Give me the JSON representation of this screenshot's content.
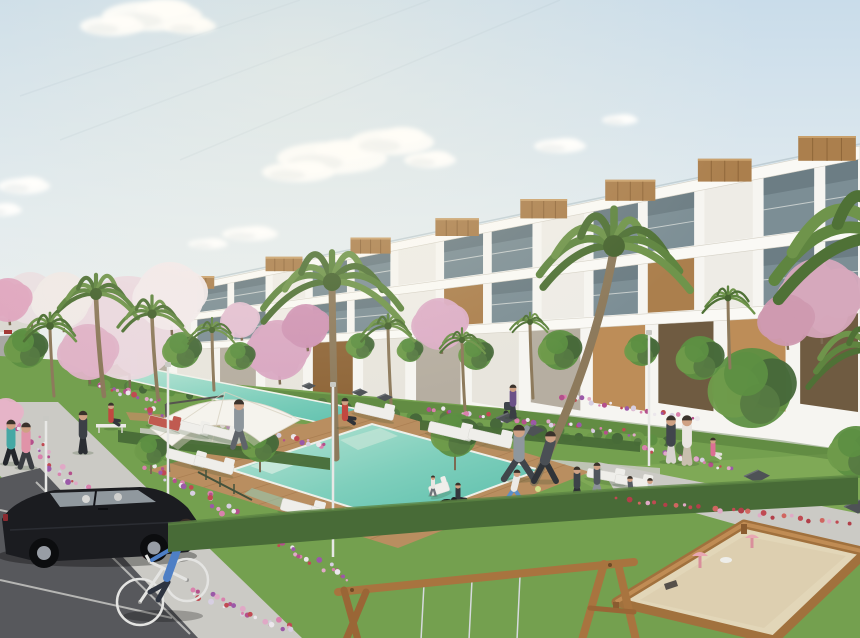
{
  "scene": {
    "description": "Photorealistic architectural rendering of a modern white terraced apartment complex with wooden accents, landscaped gardens with palm trees and pink blossoming trees, a turquoise swimming pool with wooden deck, lap pool, white sun loungers and cantilever umbrella, residents exercising and strolling, a parking area with a black hatchback, a cyclist, and a children's sandbox playground with a wooden swing frame in the foreground under a pale blue sky with wispy clouds.",
    "palette": {
      "sky_top": "#c9dcea",
      "sky_mid": "#e2ebef",
      "sky_low": "#f0f0ec",
      "cloud": "#ffffff",
      "building": "#f6f5f1",
      "fascia": "#faf9f5",
      "recess": "#b6aea1",
      "glass": "#71848d",
      "glass_light": "#aebfc6",
      "wood": "#ab7f4d",
      "wood_dark": "#8f6639",
      "tan_wall": "#bd8d58",
      "tan_shadow": "#6f5b41",
      "grass": "#74a04f",
      "grass_light": "#8fb35f",
      "grass_dark": "#41682f",
      "hedge": "#486b37",
      "deck": "#b98e60",
      "deck_dark": "#a2764a",
      "pool_light": "#b8e4d4",
      "pool": "#7fcfbc",
      "pool_deep": "#56bca9",
      "path": "#cbcac5",
      "asphalt": "#57585c",
      "sand": "#e2d6b8",
      "car": "#1b1c20",
      "white": "#efeeea",
      "bench": "#4e5256",
      "lamp": "#e8e8e6",
      "trunk": "#8d7a5c",
      "palm1": "#4f7136",
      "palm2": "#5f8540",
      "palm3": "#6f944b",
      "skin": "#cfa184"
    },
    "sky": {
      "clouds": [
        {
          "cx": 152,
          "cy": 16,
          "rx": 50,
          "ry": 15
        },
        {
          "cx": 112,
          "cy": 26,
          "rx": 32,
          "ry": 10
        },
        {
          "cx": 190,
          "cy": 26,
          "rx": 26,
          "ry": 8
        },
        {
          "cx": 332,
          "cy": 158,
          "rx": 55,
          "ry": 16
        },
        {
          "cx": 392,
          "cy": 142,
          "rx": 42,
          "ry": 13
        },
        {
          "cx": 298,
          "cy": 172,
          "rx": 36,
          "ry": 10
        },
        {
          "cx": 430,
          "cy": 160,
          "rx": 26,
          "ry": 8
        },
        {
          "cx": 24,
          "cy": 186,
          "rx": 26,
          "ry": 8
        },
        {
          "cx": 2,
          "cy": 210,
          "rx": 20,
          "ry": 6
        },
        {
          "cx": 250,
          "cy": 234,
          "rx": 28,
          "ry": 7
        },
        {
          "cx": 208,
          "cy": 244,
          "rx": 20,
          "ry": 5
        },
        {
          "cx": 560,
          "cy": 146,
          "rx": 26,
          "ry": 7
        },
        {
          "cx": 620,
          "cy": 120,
          "rx": 18,
          "ry": 5
        }
      ],
      "streaks": [
        {
          "x1": 430,
          "y1": 0,
          "x2": 60,
          "y2": 140
        },
        {
          "x1": 560,
          "y1": 0,
          "x2": 180,
          "y2": 160
        },
        {
          "x1": 300,
          "y1": 0,
          "x2": 20,
          "y2": 96
        }
      ]
    },
    "building": {
      "x0": 88,
      "x1": 860,
      "lines": [
        {
          "yl": 306,
          "yr": 146
        },
        {
          "yl": 328,
          "yr": 224
        },
        {
          "yl": 350,
          "yr": 300
        },
        {
          "yl": 374,
          "yr": 378
        }
      ],
      "fasciaL": 5,
      "fasciaR": 13,
      "roofBoxes": [
        0.12,
        0.23,
        0.34,
        0.45,
        0.56,
        0.67,
        0.79,
        0.92
      ]
    },
    "ground": {
      "polys": [
        {
          "n": "grass-base",
          "pts": "0,356 60,360 88,372 300,390 500,408 700,432 860,452 860,638 0,638",
          "f": "grass"
        },
        {
          "n": "grass-sun-patch",
          "pts": "560,470 860,452 860,520 620,502",
          "f": "grass_light",
          "o": 0.45
        },
        {
          "n": "grass-sun-patch",
          "pts": "180,430 360,448 360,470 200,452",
          "f": "grass_light",
          "o": 0.3
        },
        {
          "n": "building-shadow",
          "pts": "88,374 300,392 560,414 780,440 860,452 860,464 780,452 560,426 300,404 88,386",
          "f": "grass_dark",
          "o": 0.35
        },
        {
          "n": "mid-walkway",
          "pts": "140,428 660,468 660,480 140,440",
          "f": "path",
          "o": 0.85
        },
        {
          "n": "right-walkway",
          "pts": "598,462 862,514 862,560 614,490",
          "f": "path"
        },
        {
          "n": "left-sidewalk",
          "pts": "0,402 58,402 302,638 180,638 0,476",
          "f": "path"
        },
        {
          "n": "parking-asphalt",
          "pts": "0,478 40,468 198,638 0,638",
          "f": "asphalt"
        }
      ],
      "parkingLines": [
        {
          "x1": 0,
          "y1": 510,
          "x2": 128,
          "y2": 538
        },
        {
          "x1": 0,
          "y1": 580,
          "x2": 172,
          "y2": 618
        },
        {
          "x1": 36,
          "y1": 482,
          "x2": 190,
          "y2": 634
        }
      ]
    },
    "water": {
      "lapPool": "120,378 156,370 394,416 352,430",
      "lapDeck": "126,412 394,430 398,440 130,420",
      "mainDeck": "148,470 368,406 590,472 398,548",
      "mainPool": "232,470 372,424 540,470 398,522",
      "highlights": [
        {
          "pts": "250,466 290,452 306,460 272,474",
          "f": "#cdeadd",
          "o": 0.85
        },
        {
          "pts": "340,440 380,428 398,436 358,450",
          "f": "#bfe4d4",
          "o": 0.8
        },
        {
          "pts": "252,488 296,502 282,508 244,494",
          "f": "#8fd3c0",
          "o": 0.5
        }
      ],
      "upperHedges": [
        "118,430 330,458 330,470 118,442",
        "420,420 640,442 640,452 420,430"
      ]
    },
    "flowerBeds": [
      {
        "x1": 30,
        "y1": 436,
        "x2": 148,
        "y2": 556,
        "n": 46,
        "s": 10
      },
      {
        "x1": 152,
        "y1": 464,
        "x2": 348,
        "y2": 584,
        "n": 55,
        "s": 9
      },
      {
        "x1": 142,
        "y1": 410,
        "x2": 330,
        "y2": 448,
        "n": 38,
        "s": 7
      },
      {
        "x1": 428,
        "y1": 408,
        "x2": 638,
        "y2": 434,
        "n": 34,
        "s": 6
      },
      {
        "x1": 560,
        "y1": 396,
        "x2": 700,
        "y2": 420,
        "n": 24,
        "s": 5
      },
      {
        "x1": 642,
        "y1": 448,
        "x2": 736,
        "y2": 470,
        "n": 20,
        "s": 5
      },
      {
        "x1": 192,
        "y1": 592,
        "x2": 298,
        "y2": 634,
        "n": 28,
        "s": 8
      },
      {
        "x1": 0,
        "y1": 416,
        "x2": 26,
        "y2": 430,
        "n": 10,
        "s": 5
      },
      {
        "x1": 96,
        "y1": 386,
        "x2": 160,
        "y2": 402,
        "n": 16,
        "s": 5
      }
    ],
    "redBedOnHedge": {
      "x1": 620,
      "y1": 500,
      "x2": 858,
      "y2": 524,
      "n": 26,
      "s": 4
    },
    "greenScatter": {
      "x1": 92,
      "y1": 382,
      "x2": 690,
      "y2": 448,
      "n": 60,
      "s": 8
    },
    "flowerColors": [
      "#d981ad",
      "#b4508c",
      "#ece7ec",
      "#c04a52",
      "#9b59a8",
      "#e0a9c6",
      "#d7cfe2"
    ],
    "redColors": [
      "#c04a52",
      "#b23f49",
      "#d06660",
      "#e0a9c6"
    ],
    "greenColors": [
      "#5d8f42",
      "#47683a",
      "#6f9b4b",
      "#567a42"
    ],
    "blossoms": [
      {
        "cx": 128,
        "cy": 328,
        "r": 52,
        "c": "#ead8de"
      },
      {
        "cx": 170,
        "cy": 296,
        "r": 34,
        "c": "#f1e9ea"
      },
      {
        "cx": 88,
        "cy": 352,
        "r": 28,
        "c": "#dfb3c7"
      },
      {
        "cx": 278,
        "cy": 350,
        "r": 30,
        "c": "#d9a6c2"
      },
      {
        "cx": 306,
        "cy": 326,
        "r": 22,
        "c": "#cf93b4"
      },
      {
        "cx": 440,
        "cy": 324,
        "r": 26,
        "c": "#dcaec7"
      },
      {
        "cx": 820,
        "cy": 298,
        "r": 40,
        "c": "#d6a8bc"
      },
      {
        "cx": 786,
        "cy": 320,
        "r": 26,
        "c": "#cf9ab0"
      },
      {
        "cx": 30,
        "cy": 298,
        "r": 26,
        "c": "#eadfe2"
      },
      {
        "cx": 62,
        "cy": 300,
        "r": 28,
        "c": "#efe9e6"
      },
      {
        "cx": 8,
        "cy": 300,
        "r": 22,
        "c": "#dfa8c0"
      },
      {
        "cx": 6,
        "cy": 414,
        "r": 16,
        "c": "#e6b4c8"
      },
      {
        "cx": 240,
        "cy": 320,
        "r": 18,
        "c": "#e3c0d2"
      }
    ],
    "greenTrees": [
      {
        "cx": 752,
        "cy": 388,
        "r": 40
      },
      {
        "cx": 700,
        "cy": 358,
        "r": 22
      },
      {
        "cx": 560,
        "cy": 350,
        "r": 20
      },
      {
        "cx": 476,
        "cy": 354,
        "r": 16
      },
      {
        "cx": 642,
        "cy": 350,
        "r": 16
      },
      {
        "cx": 182,
        "cy": 350,
        "r": 18
      },
      {
        "cx": 240,
        "cy": 356,
        "r": 14
      },
      {
        "cx": 26,
        "cy": 348,
        "r": 20
      },
      {
        "cx": 360,
        "cy": 346,
        "r": 13
      },
      {
        "cx": 410,
        "cy": 350,
        "r": 12
      },
      {
        "cx": 151,
        "cy": 450,
        "r": 15,
        "trunk": true
      },
      {
        "cx": 260,
        "cy": 445,
        "r": 17,
        "trunk": true
      },
      {
        "cx": 455,
        "cy": 435,
        "r": 22,
        "trunk": true
      },
      {
        "cx": 856,
        "cy": 452,
        "r": 26
      }
    ],
    "palms": [
      {
        "cx": 332,
        "cy": 282,
        "r": 70,
        "bx": 336,
        "by": 458
      },
      {
        "cx": 614,
        "cy": 246,
        "r": 84,
        "bx": 534,
        "by": 482
      },
      {
        "cx": 96,
        "cy": 294,
        "r": 46,
        "bx": 104,
        "by": 396
      },
      {
        "cx": 152,
        "cy": 314,
        "r": 36,
        "bx": 158,
        "by": 398
      },
      {
        "cx": 50,
        "cy": 326,
        "r": 30,
        "bx": 54,
        "by": 396
      },
      {
        "cx": 212,
        "cy": 330,
        "r": 24,
        "bx": 214,
        "by": 390
      },
      {
        "cx": 388,
        "cy": 326,
        "r": 28,
        "bx": 392,
        "by": 418
      },
      {
        "cx": 462,
        "cy": 340,
        "r": 24,
        "bx": 465,
        "by": 410
      },
      {
        "cx": 530,
        "cy": 322,
        "r": 20,
        "bx": 533,
        "by": 398
      },
      {
        "cx": 728,
        "cy": 298,
        "r": 26,
        "bx": 730,
        "by": 368
      }
    ],
    "cornerPalms": [
      {
        "cx": 884,
        "cy": 238,
        "r": 130,
        "noTrunk": true
      },
      {
        "cx": 872,
        "cy": 350,
        "r": 66,
        "noTrunk": true
      }
    ],
    "frontHedge": "168,524 300,512 470,500 640,488 858,476 858,504 640,516 470,528 300,542 168,552",
    "loungers": [
      {
        "x": 356,
        "y": 402,
        "w": 40,
        "h": 10,
        "rot": 13
      },
      {
        "x": 430,
        "y": 421,
        "w": 44,
        "h": 11,
        "rot": 13
      },
      {
        "x": 470,
        "y": 428,
        "w": 44,
        "h": 11,
        "rot": 13
      },
      {
        "x": 283,
        "y": 498,
        "w": 44,
        "h": 12,
        "rot": 15
      },
      {
        "x": 312,
        "y": 506,
        "w": 44,
        "h": 12,
        "rot": 15
      },
      {
        "x": 175,
        "y": 419,
        "w": 36,
        "h": 9,
        "rot": 14
      },
      {
        "x": 204,
        "y": 424,
        "w": 36,
        "h": 9,
        "rot": 14
      },
      {
        "x": 150,
        "y": 415,
        "w": 32,
        "h": 9,
        "rot": 14,
        "c": "#c05a50"
      },
      {
        "x": 168,
        "y": 448,
        "w": 40,
        "h": 10,
        "rot": 15
      },
      {
        "x": 196,
        "y": 455,
        "w": 40,
        "h": 10,
        "rot": 15
      },
      {
        "x": 588,
        "y": 468,
        "w": 38,
        "h": 9,
        "rot": 10
      },
      {
        "x": 616,
        "y": 474,
        "w": 38,
        "h": 9,
        "rot": 10
      },
      {
        "x": 428,
        "y": 487,
        "w": 20,
        "h": 10,
        "rot": -18
      }
    ],
    "benches": [
      {
        "x": 496,
        "y": 413,
        "w": 22,
        "h": 13
      },
      {
        "x": 521,
        "y": 425,
        "w": 24,
        "h": 14
      },
      {
        "x": 744,
        "y": 470,
        "w": 26,
        "h": 16
      },
      {
        "x": 806,
        "y": 484,
        "w": 30,
        "h": 18
      },
      {
        "x": 844,
        "y": 500,
        "w": 28,
        "h": 17
      },
      {
        "x": 352,
        "y": 389,
        "w": 16,
        "h": 9
      },
      {
        "x": 377,
        "y": 394,
        "w": 16,
        "h": 9
      },
      {
        "x": 302,
        "y": 383,
        "w": 14,
        "h": 8
      }
    ],
    "lamps": [
      {
        "x": 333,
        "y1": 386,
        "y2": 557
      },
      {
        "x": 649,
        "y1": 334,
        "y2": 466
      },
      {
        "x": 168,
        "y1": 366,
        "y2": 497
      },
      {
        "x": 46,
        "y1": 420,
        "y2": 552
      }
    ],
    "people": [
      {
        "x": 11,
        "y": 463,
        "h": 40,
        "pose": "walk",
        "top": "#45a8a4",
        "bottom": "#23262b"
      },
      {
        "x": 26,
        "y": 467,
        "h": 41,
        "pose": "walk",
        "top": "#e093a8",
        "bottom": "#3a3d42"
      },
      {
        "x": 83,
        "y": 452,
        "h": 38,
        "pose": "stand",
        "top": "#3c4046",
        "bottom": "#2b2e33"
      },
      {
        "x": 111,
        "y": 428,
        "h": 26,
        "pose": "sit",
        "top": "#c24840",
        "bottom": "#33363b"
      },
      {
        "x": 239,
        "y": 447,
        "h": 44,
        "pose": "walk",
        "top": "#8d969c",
        "bottom": "#5f646a"
      },
      {
        "x": 345,
        "y": 427,
        "h": 30,
        "pose": "sit",
        "top": "#c24840",
        "bottom": "#2f3237"
      },
      {
        "x": 519,
        "y": 479,
        "h": 50,
        "pose": "stretch",
        "top": "#8e979d",
        "bottom": "#40454b"
      },
      {
        "x": 514,
        "y": 502,
        "h": 30,
        "pose": "lunge",
        "top": "#eceae6",
        "bottom": "#5c8fc9"
      },
      {
        "x": 545,
        "y": 481,
        "h": 46,
        "pose": "run",
        "top": "#4a4f55",
        "bottom": "#303439"
      },
      {
        "x": 577,
        "y": 499,
        "h": 30,
        "pose": "walk",
        "top": "#3d4249",
        "bottom": "#2d3035"
      },
      {
        "x": 597,
        "y": 495,
        "h": 30,
        "pose": "walk",
        "top": "#50565d",
        "bottom": "#8b9197"
      },
      {
        "x": 630,
        "y": 497,
        "h": 24,
        "pose": "kneel",
        "top": "#565c63",
        "bottom": "#3a3e44"
      },
      {
        "x": 650,
        "y": 499,
        "h": 24,
        "pose": "kneel",
        "top": "#cdd1d4",
        "bottom": "#4a4e54"
      },
      {
        "x": 671,
        "y": 461,
        "h": 42,
        "pose": "stand",
        "top": "#41464c",
        "bottom": "#d8d4cf"
      },
      {
        "x": 687,
        "y": 463,
        "h": 44,
        "pose": "stand",
        "top": "#eae6e1",
        "bottom": "#c9bfae"
      },
      {
        "x": 713,
        "y": 461,
        "h": 24,
        "pose": "sit",
        "top": "#dd6f94",
        "bottom": "#e3e0db"
      },
      {
        "x": 513,
        "y": 417,
        "h": 30,
        "pose": "stand",
        "top": "#6b5188",
        "bottom": "#3a3e44"
      },
      {
        "x": 458,
        "y": 506,
        "h": 24,
        "pose": "sit",
        "top": "#34383d",
        "bottom": "#26292d"
      },
      {
        "x": 433,
        "y": 495,
        "h": 18,
        "pose": "walk",
        "top": "#e9e7e3",
        "bottom": "#6f747a"
      }
    ],
    "dog": {
      "x": 447,
      "y": 503
    },
    "ball": {
      "x": 538,
      "y": 489,
      "r": 3,
      "c": "#cfe08a"
    }
  }
}
